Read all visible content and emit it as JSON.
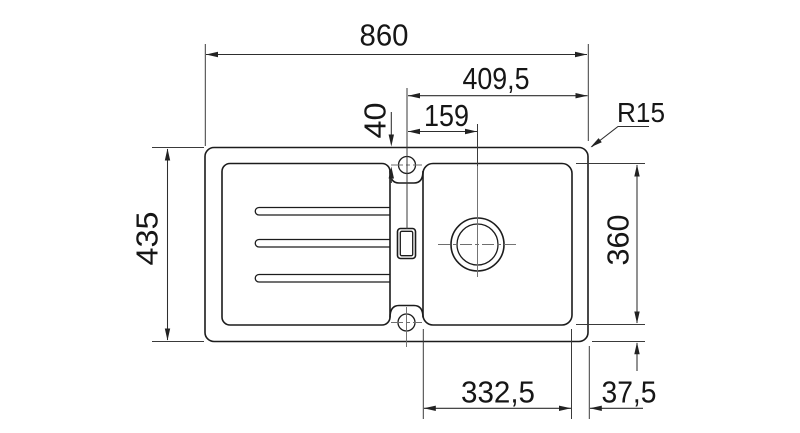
{
  "drawing": {
    "labels": {
      "overall_width": "860",
      "tap_center_to_right_edge": "409,5",
      "tap_center_to_drain_center": "159",
      "tap_center_from_top_edge": "40",
      "corner_radius": "R15",
      "overall_depth": "435",
      "bowl_depth": "360",
      "bowl_width": "332,5",
      "bowl_to_right_edge": "37,5"
    }
  }
}
